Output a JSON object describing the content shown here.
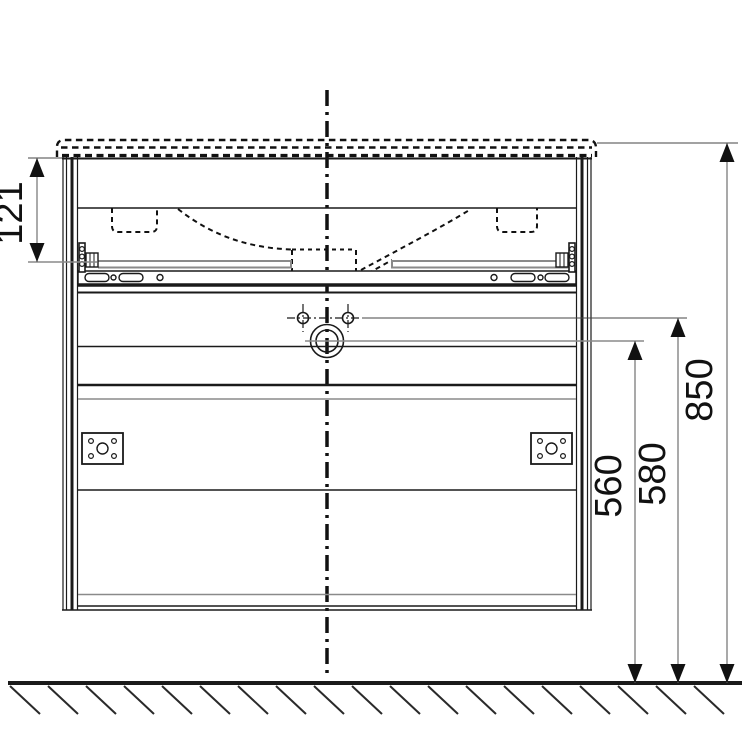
{
  "drawing": {
    "type": "technical-dimension-drawing",
    "subject": "wall-hung vanity unit with washbasin, front view",
    "dimensions": {
      "d121": {
        "label": "121"
      },
      "d560": {
        "label": "560"
      },
      "d580": {
        "label": "580"
      },
      "d850": {
        "label": "850"
      }
    },
    "parts": {
      "washbasin_outline": "dashed hidden line",
      "centerline": "vertical dash-dot axis",
      "faucet_holes": 2,
      "drain_hole": 1,
      "mounting_plates": 2,
      "drawer_slide": "full-width rail with slots",
      "ground": "hatched floor line"
    },
    "colors": {
      "line": "#1a1a1a",
      "gray_line": "#8a8a8a",
      "dim_line": "#707070",
      "background": "#ffffff"
    }
  }
}
